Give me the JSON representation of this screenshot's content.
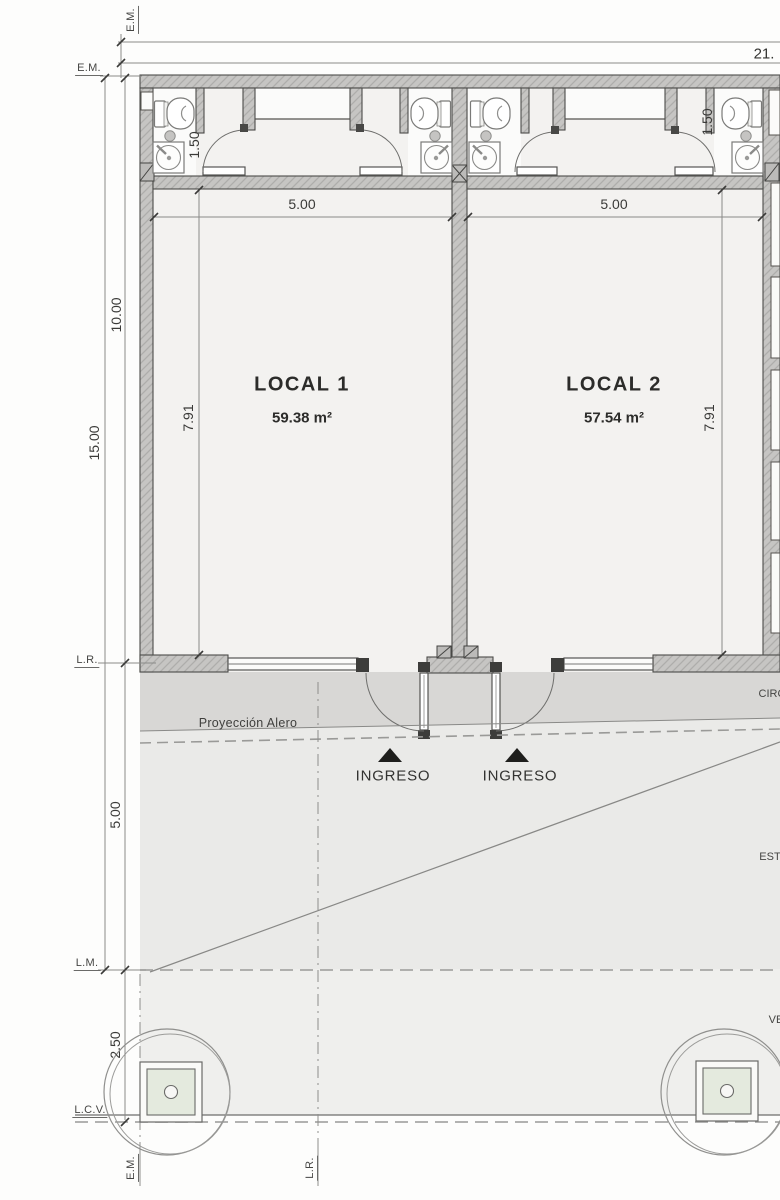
{
  "boundary_labels": {
    "em_top": "E.M.",
    "em_left": "E.M.",
    "lr_left": "L.R.",
    "lm_left": "L.M.",
    "lcv_left": "L.C.V.",
    "em_bottom": "E.M.",
    "lr_bottom": "L.R."
  },
  "dimensions": {
    "total_width": "21.",
    "left_total": "15.00",
    "left_upper": "10.00",
    "left_lower": "5.00",
    "sidewalk_depth": "2.50",
    "local1_width": "5.00",
    "local2_width": "5.00",
    "local1_depth": "7.91",
    "local2_depth": "7.91",
    "bath1_width": "1.50",
    "bath2_width": "1.50"
  },
  "rooms": {
    "local1": {
      "name": "LOCAL 1",
      "area": "59.38 m²"
    },
    "local2": {
      "name": "LOCAL 2",
      "area": "57.54 m²"
    }
  },
  "annotations": {
    "eave_projection": "Proyección Alero",
    "entrance_left": "INGRESO",
    "entrance_right": "INGRESO",
    "circulation_cut": "CIRC",
    "parking_cut": "EST",
    "sidewalk_cut": "VE"
  },
  "colors": {
    "wall": "#c6c5c3",
    "line": "#4c4c4a",
    "eave_band": "#d8d7d5",
    "parking": "#eaeae8",
    "sidewalk": "#efefed",
    "room": "#f3f2f0",
    "bath": "#fbfbfa",
    "planter": "#e4eade"
  }
}
